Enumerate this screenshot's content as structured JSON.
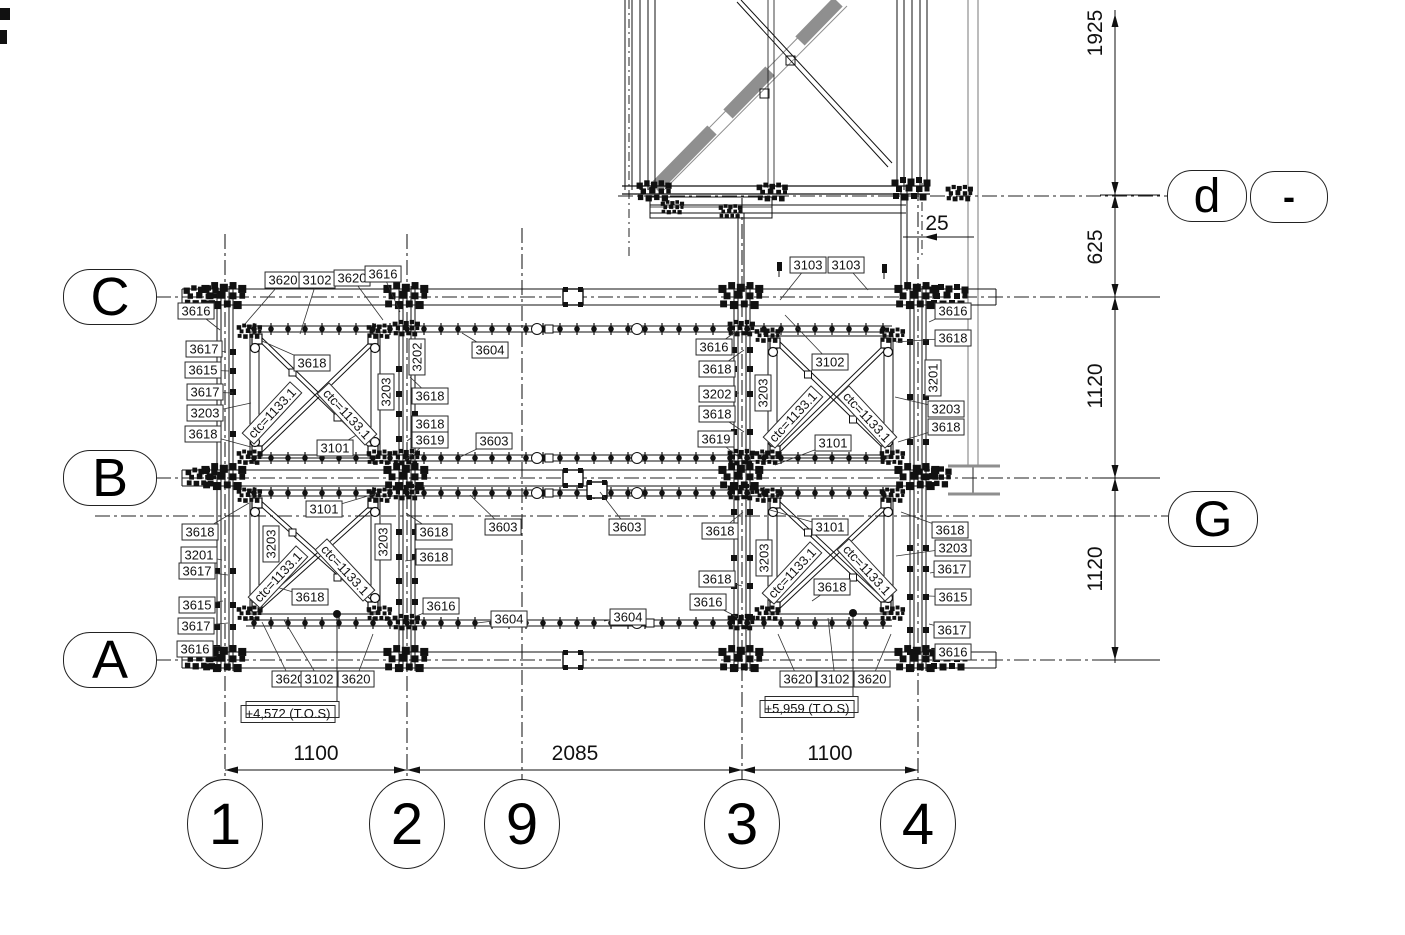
{
  "title": "Structural steel framing plan (braced bays)",
  "colors": {
    "line": "#111111",
    "gray_member": "#8f8f8f",
    "background": "#ffffff",
    "label_border": "#2a2a2a"
  },
  "grid_bubbles": [
    {
      "label": "C",
      "x": 110,
      "y": 297,
      "w": 92,
      "h": 54,
      "shape": "stadium",
      "font": 54
    },
    {
      "label": "B",
      "x": 110,
      "y": 478,
      "w": 92,
      "h": 54,
      "shape": "stadium",
      "font": 54
    },
    {
      "label": "A",
      "x": 110,
      "y": 660,
      "w": 92,
      "h": 54,
      "shape": "stadium",
      "font": 54
    },
    {
      "label": "d",
      "x": 1207,
      "y": 196,
      "w": 78,
      "h": 50,
      "shape": "stadium",
      "font": 48
    },
    {
      "label": "-",
      "x": 1289,
      "y": 197,
      "w": 76,
      "h": 50,
      "shape": "stadium",
      "font": 36,
      "bold": true
    },
    {
      "label": "G",
      "x": 1213,
      "y": 519,
      "w": 88,
      "h": 54,
      "shape": "stadium",
      "font": 50
    },
    {
      "label": "1",
      "x": 225,
      "y": 824,
      "w": 74,
      "h": 88,
      "shape": "round",
      "font": 58
    },
    {
      "label": "2",
      "x": 407,
      "y": 824,
      "w": 74,
      "h": 88,
      "shape": "round",
      "font": 58
    },
    {
      "label": "9",
      "x": 522,
      "y": 824,
      "w": 74,
      "h": 88,
      "shape": "round",
      "font": 58
    },
    {
      "label": "3",
      "x": 742,
      "y": 824,
      "w": 74,
      "h": 88,
      "shape": "round",
      "font": 58
    },
    {
      "label": "4",
      "x": 918,
      "y": 824,
      "w": 74,
      "h": 88,
      "shape": "round",
      "font": 58
    }
  ],
  "dimensions": {
    "bottom": [
      {
        "text": "1100",
        "x": 316,
        "y": 754
      },
      {
        "text": "2085",
        "x": 575,
        "y": 754
      },
      {
        "text": "1100",
        "x": 830,
        "y": 754
      }
    ],
    "right": [
      {
        "text": "1925",
        "x": 1096,
        "y": 33
      },
      {
        "text": "625",
        "x": 1096,
        "y": 247
      },
      {
        "text": "1120",
        "x": 1096,
        "y": 386
      },
      {
        "text": "1120",
        "x": 1096,
        "y": 569
      }
    ],
    "offset": {
      "text": "25",
      "x": 937,
      "y": 224
    }
  },
  "elevations": [
    {
      "text": "+4,572 (T.O.S)",
      "x": 288,
      "y": 714
    },
    {
      "text": "+5,959 (T.O.S)",
      "x": 807,
      "y": 709
    }
  ],
  "brace_labels": [
    {
      "t": "ctc=1133.1",
      "x": 272,
      "y": 413,
      "r": -47
    },
    {
      "t": "ctc=1133.1",
      "x": 347,
      "y": 414,
      "r": 47
    },
    {
      "t": "ctc=1133.1",
      "x": 793,
      "y": 417,
      "r": -47
    },
    {
      "t": "ctc=1133.1",
      "x": 867,
      "y": 417,
      "r": 47
    },
    {
      "t": "ctc=1133.1",
      "x": 278,
      "y": 577,
      "r": -47
    },
    {
      "t": "ctc=1133.1",
      "x": 345,
      "y": 570,
      "r": 47
    },
    {
      "t": "ctc=1133.1",
      "x": 792,
      "y": 573,
      "r": -47
    },
    {
      "t": "ctc=1133.1",
      "x": 867,
      "y": 570,
      "r": 47
    }
  ],
  "part_labels": [
    {
      "t": "3620",
      "x": 283,
      "y": 280,
      "lx": 245,
      "ly": 324
    },
    {
      "t": "3102",
      "x": 317,
      "y": 280,
      "lx": 300,
      "ly": 334
    },
    {
      "t": "3620",
      "x": 352,
      "y": 278,
      "lx": 383,
      "ly": 320
    },
    {
      "t": "3616",
      "x": 383,
      "y": 274,
      "lx": 400,
      "ly": 312
    },
    {
      "t": "3616",
      "x": 196,
      "y": 311,
      "lx": 220,
      "ly": 330
    },
    {
      "t": "3617",
      "x": 204,
      "y": 349,
      "lx": 226,
      "ly": 352
    },
    {
      "t": "3615",
      "x": 203,
      "y": 370,
      "lx": 229,
      "ly": 371
    },
    {
      "t": "3617",
      "x": 205,
      "y": 392,
      "lx": 233,
      "ly": 393
    },
    {
      "t": "3203",
      "x": 205,
      "y": 413,
      "lx": 251,
      "ly": 403
    },
    {
      "t": "3618",
      "x": 203,
      "y": 434,
      "lx": 251,
      "ly": 447
    },
    {
      "t": "3618",
      "x": 312,
      "y": 363,
      "lx": 262,
      "ly": 341
    },
    {
      "t": "3101",
      "x": 335,
      "y": 448,
      "lx": 368,
      "ly": 428
    },
    {
      "t": "3202",
      "x": 417,
      "y": 357,
      "r": -90
    },
    {
      "t": "3203",
      "x": 386,
      "y": 392,
      "r": -90
    },
    {
      "t": "3618",
      "x": 430,
      "y": 396,
      "lx": 410,
      "ly": 377
    },
    {
      "t": "3618",
      "x": 430,
      "y": 424,
      "lx": 407,
      "ly": 441
    },
    {
      "t": "3619",
      "x": 430,
      "y": 440,
      "lx": 404,
      "ly": 461
    },
    {
      "t": "3604",
      "x": 490,
      "y": 350,
      "lx": 462,
      "ly": 333
    },
    {
      "t": "3603",
      "x": 494,
      "y": 441,
      "lx": 460,
      "ly": 457
    },
    {
      "t": "3616",
      "x": 714,
      "y": 347,
      "lx": 737,
      "ly": 331
    },
    {
      "t": "3618",
      "x": 717,
      "y": 369,
      "lx": 744,
      "ly": 350
    },
    {
      "t": "3202",
      "x": 717,
      "y": 394,
      "lx": 739,
      "ly": 393
    },
    {
      "t": "3618",
      "x": 717,
      "y": 414,
      "lx": 744,
      "ly": 432
    },
    {
      "t": "3619",
      "x": 716,
      "y": 439,
      "lx": 741,
      "ly": 459
    },
    {
      "t": "3203",
      "x": 763,
      "y": 393,
      "r": -90
    },
    {
      "t": "3103",
      "x": 808,
      "y": 265,
      "lx": 780,
      "ly": 300
    },
    {
      "t": "3103",
      "x": 846,
      "y": 265,
      "lx": 868,
      "ly": 290
    },
    {
      "t": "3102",
      "x": 830,
      "y": 362,
      "lx": 785,
      "ly": 315
    },
    {
      "t": "3101",
      "x": 833,
      "y": 443,
      "lx": 775,
      "ly": 465
    },
    {
      "t": "3616",
      "x": 953,
      "y": 311,
      "lx": 929,
      "ly": 322
    },
    {
      "t": "3618",
      "x": 953,
      "y": 338,
      "lx": 896,
      "ly": 342
    },
    {
      "t": "3201",
      "x": 933,
      "y": 378,
      "r": -90
    },
    {
      "t": "3203",
      "x": 946,
      "y": 409,
      "lx": 895,
      "ly": 397
    },
    {
      "t": "3618",
      "x": 946,
      "y": 427,
      "lx": 898,
      "ly": 442
    },
    {
      "t": "3101",
      "x": 324,
      "y": 509,
      "lx": 378,
      "ly": 493
    },
    {
      "t": "3618",
      "x": 200,
      "y": 532,
      "lx": 249,
      "ly": 503
    },
    {
      "t": "3201",
      "x": 199,
      "y": 555,
      "lx": 222,
      "ly": 560
    },
    {
      "t": "3617",
      "x": 197,
      "y": 571,
      "lx": 228,
      "ly": 575
    },
    {
      "t": "3615",
      "x": 197,
      "y": 605,
      "lx": 223,
      "ly": 601
    },
    {
      "t": "3617",
      "x": 196,
      "y": 626,
      "lx": 228,
      "ly": 623
    },
    {
      "t": "3616",
      "x": 195,
      "y": 649,
      "lx": 221,
      "ly": 646
    },
    {
      "t": "3203",
      "x": 271,
      "y": 544,
      "r": -90
    },
    {
      "t": "3618",
      "x": 310,
      "y": 597,
      "lx": 266,
      "ly": 584
    },
    {
      "t": "3620",
      "x": 290,
      "y": 679,
      "lx": 262,
      "ly": 622
    },
    {
      "t": "3102",
      "x": 319,
      "y": 679,
      "lx": 284,
      "ly": 620
    },
    {
      "t": "3620",
      "x": 356,
      "y": 679,
      "lx": 373,
      "ly": 634
    },
    {
      "t": "3203",
      "x": 383,
      "y": 542,
      "r": -90
    },
    {
      "t": "3618",
      "x": 434,
      "y": 532,
      "lx": 406,
      "ly": 513
    },
    {
      "t": "3618",
      "x": 434,
      "y": 557,
      "lx": 405,
      "ly": 561
    },
    {
      "t": "3616",
      "x": 441,
      "y": 606,
      "lx": 414,
      "ly": 617
    },
    {
      "t": "3603",
      "x": 503,
      "y": 527,
      "lx": 470,
      "ly": 495
    },
    {
      "t": "3603",
      "x": 627,
      "y": 527,
      "lx": 600,
      "ly": 492
    },
    {
      "t": "3604",
      "x": 509,
      "y": 619,
      "lx": 477,
      "ly": 623
    },
    {
      "t": "3604",
      "x": 628,
      "y": 617,
      "lx": 604,
      "ly": 621
    },
    {
      "t": "3618",
      "x": 720,
      "y": 531,
      "lx": 743,
      "ly": 512
    },
    {
      "t": "3203",
      "x": 764,
      "y": 558,
      "r": -90
    },
    {
      "t": "3618",
      "x": 717,
      "y": 579,
      "lx": 742,
      "ly": 586
    },
    {
      "t": "3616",
      "x": 708,
      "y": 602,
      "lx": 737,
      "ly": 617
    },
    {
      "t": "3101",
      "x": 830,
      "y": 527,
      "lx": 770,
      "ly": 510
    },
    {
      "t": "3618",
      "x": 832,
      "y": 587,
      "lx": 812,
      "ly": 601
    },
    {
      "t": "3620",
      "x": 798,
      "y": 679,
      "lx": 778,
      "ly": 634
    },
    {
      "t": "3102",
      "x": 835,
      "y": 679,
      "lx": 828,
      "ly": 618
    },
    {
      "t": "3620",
      "x": 872,
      "y": 679,
      "lx": 891,
      "ly": 634
    },
    {
      "t": "3618",
      "x": 950,
      "y": 530,
      "lx": 901,
      "ly": 512
    },
    {
      "t": "3203",
      "x": 953,
      "y": 548,
      "lx": 896,
      "ly": 556
    },
    {
      "t": "3617",
      "x": 952,
      "y": 569,
      "lx": 930,
      "ly": 573
    },
    {
      "t": "3615",
      "x": 953,
      "y": 597,
      "lx": 929,
      "ly": 596
    },
    {
      "t": "3617",
      "x": 952,
      "y": 630,
      "lx": 929,
      "ly": 624
    },
    {
      "t": "3616",
      "x": 953,
      "y": 652,
      "lx": 927,
      "ly": 649
    }
  ]
}
